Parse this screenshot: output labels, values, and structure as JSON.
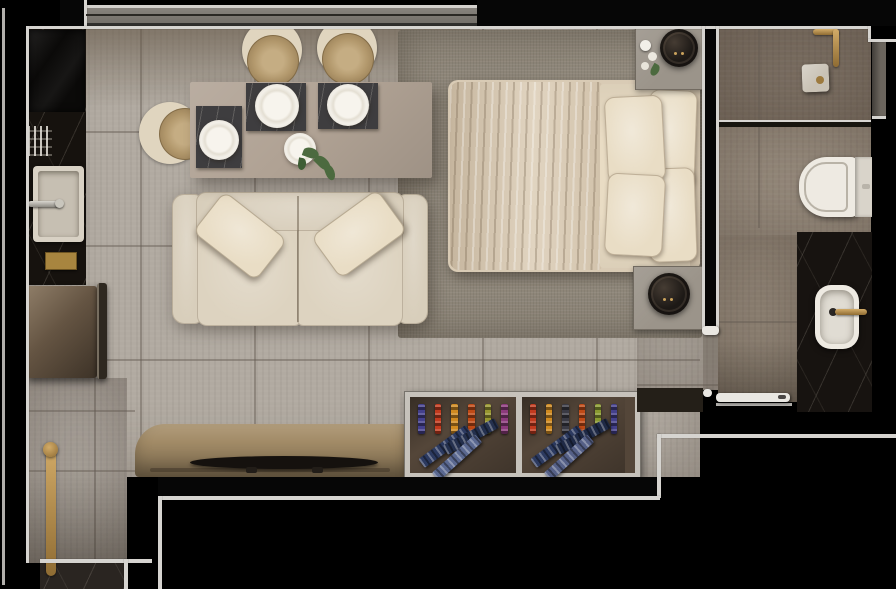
{
  "scene": {
    "type": "floor-plan-render",
    "view": "top-down",
    "unit": "studio apartment",
    "rooms": [
      "kitchen",
      "dining",
      "living",
      "bedroom",
      "bathroom",
      "entry"
    ]
  },
  "palette": {
    "outside": "#000000",
    "trim": "#d6d4d0",
    "trim_dim": "#b2b0ac",
    "window_track": "#7e7a74",
    "floor": "#b1aaa1",
    "corridor_floor": "#a7a098",
    "doorway_floor": "#a39c92",
    "rug": "#8e8679",
    "kitchen_marble": "#16120e",
    "cooktop": "#0b0a09",
    "sink_white": "#d8d1c4",
    "sink_basin": "#c6bfb2",
    "fridge_bronze": "#5d4d3c",
    "fridge_hinge": "#2e2820",
    "brass": "#b08c4e",
    "gold_plaque": "#a8853f",
    "table_taupe": "#b0a294",
    "placemat_marble": "#3e3d3f",
    "porcelain": "#eeeae2",
    "rattan": "#b2986c",
    "chair_cream": "#e0d5bf",
    "sofa_cream": "#d8cebb",
    "sofa_seat": "#ddd3c0",
    "pillow_cream": "#e9ddc5",
    "bed_frame": "#d9cbb5",
    "duvet": "#dccdb6",
    "sheet": "#e9dcc4",
    "nightstand": "#9b948a",
    "lamp_dark": "#1d1916",
    "plant_green": "#4c6a3f",
    "console_tan": "#a18a66",
    "tv_black": "#15110e",
    "shelf_frame": "#c6c2bb",
    "shelf_interior": "#544639",
    "shower_floor": "#7b6f62",
    "bath_floor": "#95897b",
    "bath_floor_lower": "#8f8375",
    "wall_niche": "#6b655d",
    "bedroom_wall_band": "#241f18",
    "vanity_marble": "#171310",
    "door_white": "#e9e7e2",
    "threshold_marble": "#2a2521"
  },
  "furniture": {
    "kitchen": [
      "counter",
      "cooktop",
      "dish-rack",
      "sink",
      "refrigerator"
    ],
    "dining": {
      "tables": 1,
      "chairs": 3,
      "place_settings": 3,
      "centerpiece": "plant"
    },
    "living": {
      "sofa_seats": 2,
      "throw_pillows": 2,
      "tv": 1,
      "tv_console": 1
    },
    "bedroom": {
      "bed": "double",
      "bed_pillows": 4,
      "nightstands": 2,
      "lamps": 2,
      "rug": 1
    },
    "bathroom": [
      "shower",
      "glass-partition",
      "toilet",
      "vanity",
      "basin",
      "faucet"
    ],
    "entry": [
      "door-pull-handle",
      "marble-threshold"
    ]
  },
  "bookshelf": {
    "compartments": [
      {
        "spines": [
          "#44408c",
          "#c23a1e",
          "#d08a20",
          "#c04a16",
          "#97962f",
          "#8c3a7c"
        ],
        "stacks": [
          "#2c3a60",
          "#24304e",
          "#5a6890"
        ]
      },
      {
        "spines": [
          "#c23a1e",
          "#d08a20",
          "#3a3a44",
          "#c04a16",
          "#8a9a30",
          "#44408c"
        ],
        "stacks": [
          "#2c3a60",
          "#1f2a46",
          "#556087"
        ]
      }
    ]
  }
}
